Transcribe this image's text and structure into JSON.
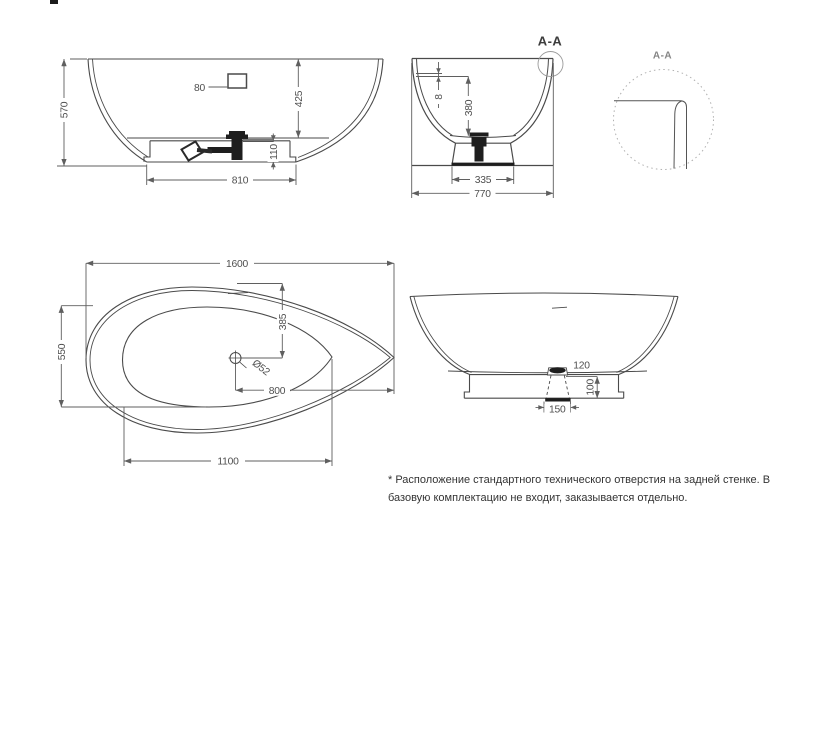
{
  "front_view": {
    "height": "570",
    "hole_distance": "80",
    "inner_depth": "425",
    "base_height": "110",
    "base_length": "810"
  },
  "section_view": {
    "label": "A-A",
    "rim_thickness": "8",
    "inner_depth": "380",
    "base_bottom_width": "335",
    "overall_width": "770"
  },
  "detail_view": {
    "label": "A-A"
  },
  "plan_view": {
    "overall_length": "1600",
    "basin_width": "550",
    "drain_to_back": "385",
    "drain_diameter": "Ø52",
    "drain_to_end": "800",
    "basin_length": "1100"
  },
  "side_view": {
    "drain_offset": "120",
    "base_height": "100",
    "drain_base_width": "150"
  },
  "note": {
    "line1": "* Расположение стандартного технического отверстия на задней стенке. В",
    "line2": "базовую комплектацию не входит, заказывается отдельно."
  },
  "colors": {
    "line": "#4a4a4a",
    "dim": "#5f5f5f",
    "note_text": "#333333"
  }
}
